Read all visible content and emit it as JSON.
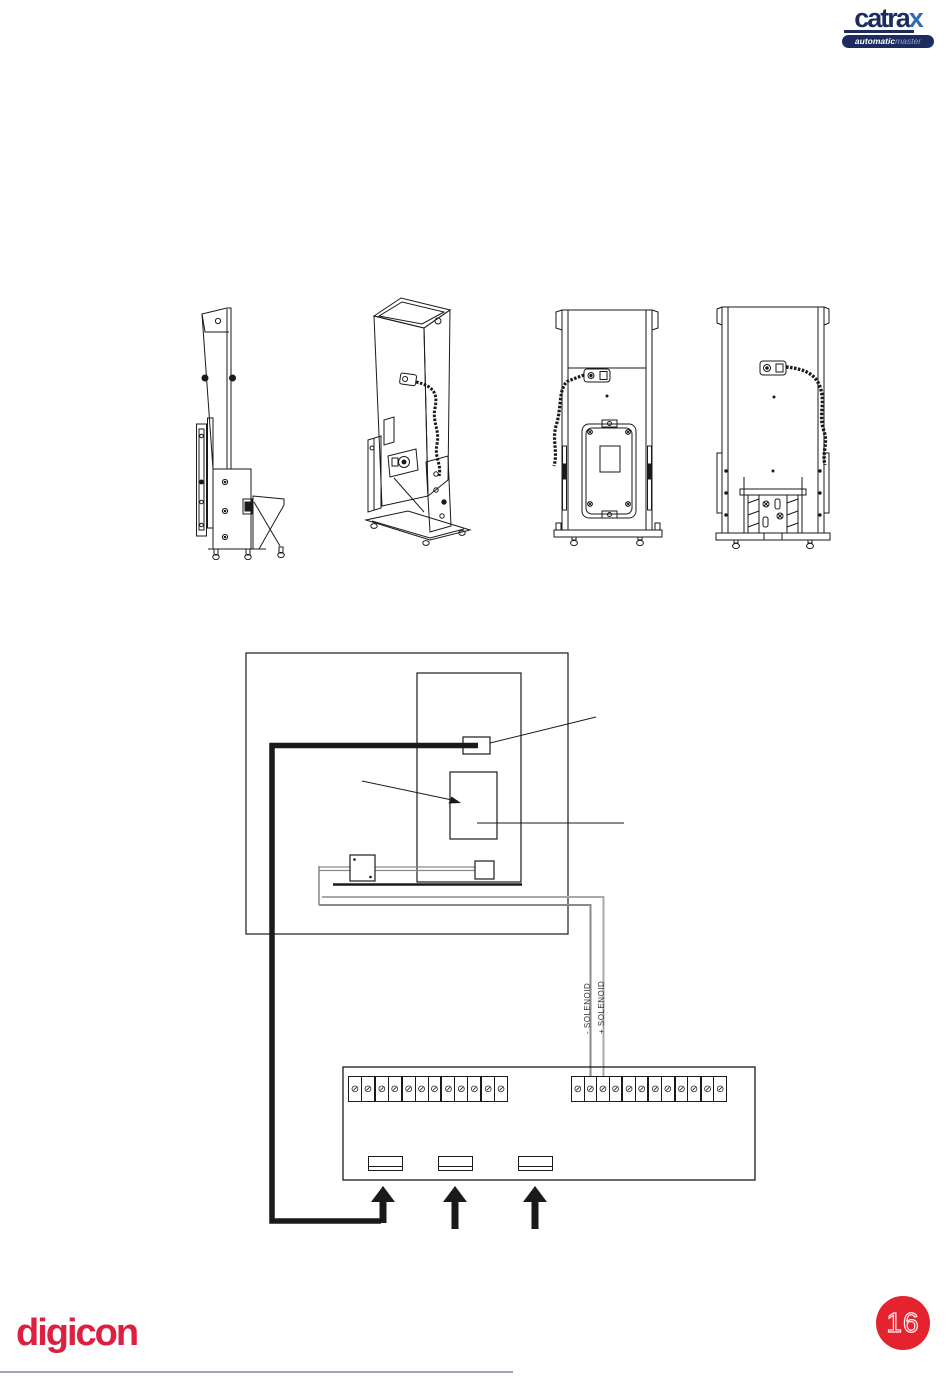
{
  "page": {
    "number": "16",
    "background": "#ffffff"
  },
  "header_logo": {
    "brand_prefix": "catra",
    "brand_suffix": "x",
    "tagline_bold": "automatic",
    "tagline_light": "master",
    "navy": "#1d2b5f",
    "blue": "#2f6cb5"
  },
  "footer_logo": {
    "brand": "digicon",
    "color": "#dc2140"
  },
  "figures": {
    "description": "Four technical line drawings of the Catrax unit",
    "views": [
      {
        "name": "side-view"
      },
      {
        "name": "perspective-view"
      },
      {
        "name": "rear-view"
      },
      {
        "name": "front-view"
      }
    ]
  },
  "wiring_diagram": {
    "labels": {
      "solenoid_minus": "- SOLENOID",
      "solenoid_plus": "+ SOLENOID"
    },
    "wire_colors": {
      "main_wire": "#1a1a1a",
      "solenoid_wire_minus": "#8a8a8a",
      "solenoid_wire_plus": "#a8a8a8"
    }
  },
  "terminal_block": {
    "screw_glyph": "⊘",
    "left_group": {
      "count": 12,
      "thick_after": [
        2,
        4,
        7,
        10
      ]
    },
    "right_group": {
      "count": 12,
      "thick_after": [
        4,
        6,
        8,
        10
      ]
    },
    "connector_count": 3,
    "arrow_count": 3
  }
}
